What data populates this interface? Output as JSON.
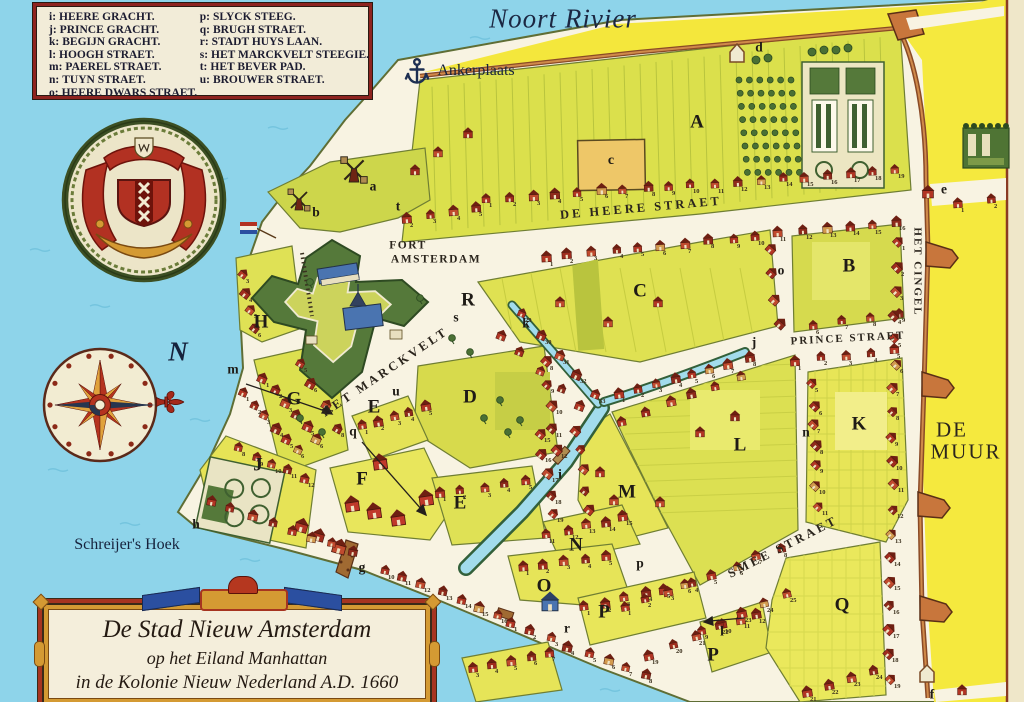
{
  "cartouche": {
    "line1": "De Stad Nieuw Amsterdam",
    "line2": "op het Eiland Manhattan",
    "line3": "in de Kolonie Nieuw Nederland A.D. 1660"
  },
  "legend": {
    "left": [
      {
        "key": "i:",
        "name": "HEERE GRACHT."
      },
      {
        "key": "j:",
        "name": "PRINCE GRACHT."
      },
      {
        "key": "k:",
        "name": "BEGIJN GRACHT."
      },
      {
        "key": "l:",
        "name": "HOOGH STRAET."
      },
      {
        "key": "m:",
        "name": "PAEREL STRAET."
      },
      {
        "key": "n:",
        "name": "TUYN STRAET."
      },
      {
        "key": "o:",
        "name": "HEERE DWARS STRAET."
      }
    ],
    "right": [
      {
        "key": "p:",
        "name": "SLYCK STEEG."
      },
      {
        "key": "q:",
        "name": "BRUGH STRAET."
      },
      {
        "key": "r:",
        "name": "STADT HUYS LAAN."
      },
      {
        "key": "s:",
        "name": "HET MARCKVELT STEEGIE."
      },
      {
        "key": "t:",
        "name": "HET  BEVER PAD."
      },
      {
        "key": "u:",
        "name": "BROUWER STRAET."
      }
    ]
  },
  "map_labels": [
    {
      "name": "label-noort-rivier",
      "text": "Noort Rivier",
      "x": 563,
      "y": 19,
      "cls": "title"
    },
    {
      "name": "label-ankerplaats",
      "text": "Ankerplaats",
      "x": 476,
      "y": 71,
      "cls": "name"
    },
    {
      "name": "label-schreijers-hoek",
      "text": "Schreijer's Hoek",
      "x": 127,
      "y": 545,
      "cls": "name"
    },
    {
      "name": "label-compass-north",
      "text": "N",
      "x": 178,
      "y": 352,
      "cls": "compassN"
    },
    {
      "name": "label-de-heere-straet",
      "text": "DE HEERE STRAET",
      "x": 641,
      "y": 208,
      "cls": "street",
      "rot": -5
    },
    {
      "name": "label-prince-straet",
      "text": "PRINCE STRAET",
      "x": 848,
      "y": 339,
      "cls": "streetsm",
      "rot": -3
    },
    {
      "name": "label-smee-straet",
      "text": "SMEE STRAET",
      "x": 783,
      "y": 547,
      "cls": "street",
      "rot": -27
    },
    {
      "name": "label-het-marckvelt",
      "text": "HET MARCKVELT",
      "x": 385,
      "y": 372,
      "cls": "street",
      "rot": -34
    },
    {
      "name": "label-het-cingel",
      "text": "HET CINGEL",
      "x": 917,
      "y": 272,
      "cls": "streetsm",
      "rot": 90
    },
    {
      "name": "label-de-muur-1",
      "text": "DE",
      "x": 952,
      "y": 430,
      "cls": "muur"
    },
    {
      "name": "label-de-muur-2",
      "text": "MUUR",
      "x": 966,
      "y": 452,
      "cls": "muur"
    },
    {
      "name": "label-fort-amsterdam-1",
      "text": "FORT",
      "x": 408,
      "y": 246,
      "cls": "fortlbl"
    },
    {
      "name": "label-fort-amsterdam-2",
      "text": "AMSTERDAM",
      "x": 436,
      "y": 260,
      "cls": "fortlbl"
    },
    {
      "name": "block-a",
      "text": "A",
      "x": 697,
      "y": 122,
      "cls": "block"
    },
    {
      "name": "block-b",
      "text": "B",
      "x": 849,
      "y": 266,
      "cls": "block"
    },
    {
      "name": "block-c",
      "text": "C",
      "x": 640,
      "y": 291,
      "cls": "block"
    },
    {
      "name": "block-c-church",
      "text": "c",
      "x": 611,
      "y": 161,
      "cls": "blocksm"
    },
    {
      "name": "block-d",
      "text": "D",
      "x": 470,
      "y": 397,
      "cls": "block"
    },
    {
      "name": "block-e-west",
      "text": "E",
      "x": 374,
      "y": 407,
      "cls": "block"
    },
    {
      "name": "block-e-south",
      "text": "E",
      "x": 460,
      "y": 503,
      "cls": "block"
    },
    {
      "name": "block-f",
      "text": "F",
      "x": 362,
      "y": 479,
      "cls": "block"
    },
    {
      "name": "block-g",
      "text": "G",
      "x": 294,
      "y": 399,
      "cls": "block"
    },
    {
      "name": "block-h",
      "text": "H",
      "x": 261,
      "y": 322,
      "cls": "block"
    },
    {
      "name": "block-j",
      "text": "J",
      "x": 258,
      "y": 465,
      "cls": "block"
    },
    {
      "name": "block-k",
      "text": "K",
      "x": 859,
      "y": 424,
      "cls": "block"
    },
    {
      "name": "block-l",
      "text": "L",
      "x": 740,
      "y": 445,
      "cls": "block"
    },
    {
      "name": "block-m",
      "text": "M",
      "x": 627,
      "y": 492,
      "cls": "block"
    },
    {
      "name": "block-n",
      "text": "N",
      "x": 576,
      "y": 545,
      "cls": "block"
    },
    {
      "name": "block-o",
      "text": "O",
      "x": 544,
      "y": 586,
      "cls": "block"
    },
    {
      "name": "block-p-1",
      "text": "P",
      "x": 604,
      "y": 612,
      "cls": "block"
    },
    {
      "name": "block-p-2",
      "text": "P",
      "x": 713,
      "y": 655,
      "cls": "block"
    },
    {
      "name": "block-q",
      "text": "Q",
      "x": 842,
      "y": 605,
      "cls": "block"
    },
    {
      "name": "block-r",
      "text": "R",
      "x": 468,
      "y": 300,
      "cls": "block"
    },
    {
      "name": "key-a",
      "text": "a",
      "x": 373,
      "y": 186,
      "cls": "small"
    },
    {
      "name": "key-b",
      "text": "b",
      "x": 316,
      "y": 212,
      "cls": "small"
    },
    {
      "name": "key-d",
      "text": "d",
      "x": 759,
      "y": 47,
      "cls": "small"
    },
    {
      "name": "key-e",
      "text": "e",
      "x": 944,
      "y": 189,
      "cls": "small"
    },
    {
      "name": "key-f",
      "text": "f",
      "x": 932,
      "y": 694,
      "cls": "small"
    },
    {
      "name": "key-g",
      "text": "g",
      "x": 362,
      "y": 567,
      "cls": "small"
    },
    {
      "name": "key-h",
      "text": "h",
      "x": 196,
      "y": 524,
      "cls": "small"
    },
    {
      "name": "key-i",
      "text": "i",
      "x": 560,
      "y": 474,
      "cls": "small"
    },
    {
      "name": "key-j",
      "text": "j",
      "x": 754,
      "y": 342,
      "cls": "small"
    },
    {
      "name": "key-k",
      "text": "k",
      "x": 526,
      "y": 323,
      "cls": "small"
    },
    {
      "name": "key-l",
      "text": "l",
      "x": 722,
      "y": 631,
      "cls": "small"
    },
    {
      "name": "key-m",
      "text": "m",
      "x": 233,
      "y": 369,
      "cls": "small"
    },
    {
      "name": "key-n",
      "text": "n",
      "x": 806,
      "y": 432,
      "cls": "small"
    },
    {
      "name": "key-o",
      "text": "o",
      "x": 781,
      "y": 270,
      "cls": "small"
    },
    {
      "name": "key-p",
      "text": "p",
      "x": 640,
      "y": 563,
      "cls": "small"
    },
    {
      "name": "key-q",
      "text": "q",
      "x": 353,
      "y": 431,
      "cls": "small"
    },
    {
      "name": "key-r",
      "text": "r",
      "x": 567,
      "y": 628,
      "cls": "small"
    },
    {
      "name": "key-s",
      "text": "s",
      "x": 456,
      "y": 317,
      "cls": "small"
    },
    {
      "name": "key-t",
      "text": "t",
      "x": 398,
      "y": 206,
      "cls": "small"
    },
    {
      "name": "key-u",
      "text": "u",
      "x": 396,
      "y": 391,
      "cls": "small"
    }
  ],
  "colors": {
    "water": "#8ed4ea",
    "street": "#f8f3e2",
    "block_yellow": "#e8e655",
    "block_olive": "#d6da4e",
    "outside_wall": "#f5e93e",
    "building_red": "#b23524",
    "fort_green": "#55793a",
    "wall_brown": "#9c5a2e",
    "legend_border": "#8e2420",
    "accent_gold": "#d49a33",
    "accent_blue": "#2b4fa0",
    "ink": "#241f1c"
  }
}
